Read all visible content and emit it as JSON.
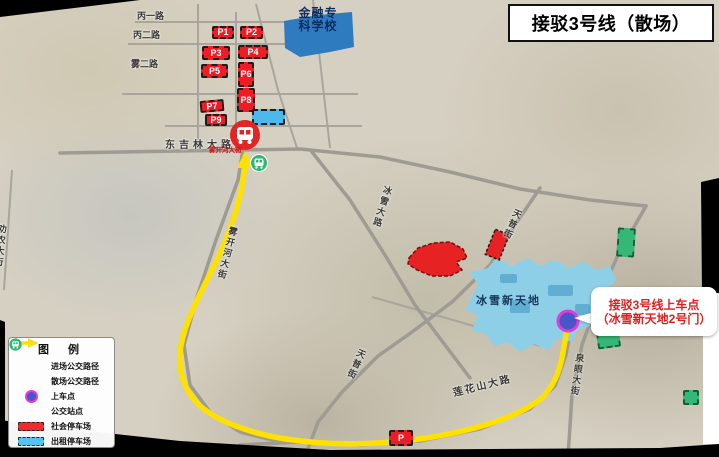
{
  "title": "接驳3号线（散场）",
  "legend": {
    "title": "图 例",
    "items": [
      {
        "label": "进场公交路径",
        "symbol": "purple-arrow",
        "color": "#7030a0"
      },
      {
        "label": "散场公交路径",
        "symbol": "yellow-arrow",
        "color": "#ffe100"
      },
      {
        "label": "上车点",
        "symbol": "boarding-dot",
        "color": "#4856c8"
      },
      {
        "label": "公交站点",
        "symbol": "bus-stop-icon",
        "color": "#2eb872"
      },
      {
        "label": "社会停车场",
        "symbol": "red-dashed-box",
        "color": "#ee2c2c"
      },
      {
        "label": "出租停车场",
        "symbol": "blue-dashed-box",
        "color": "#55c3ef"
      }
    ]
  },
  "map": {
    "school": {
      "line1": "金融专",
      "line2": "科学校"
    },
    "venue": "冰雪新天地",
    "callout": {
      "line1": "接驳3号线上车点",
      "line2": "（冰雪新天地2号门）"
    },
    "stop_name": "雾开河大街",
    "roads": {
      "bingyi": "丙一路",
      "binger": "丙二路",
      "wuer": "雾二路",
      "dongjilin": "东吉林大路",
      "wukaihe": "雾开河大街",
      "bingxue": "冰雪大路",
      "tianpu_north": "天普街",
      "tianpu_south": "天普街",
      "quanyan": "泉眼大街",
      "lianhuashan": "莲花山大路",
      "quannong": "劝农大街"
    },
    "parking": {
      "p1": "P1",
      "p2": "P2",
      "p3": "P3",
      "p4": "P4",
      "p5": "P5",
      "p6": "P6",
      "p7": "P7",
      "p8": "P8",
      "p9": "P9",
      "p_south": "P"
    }
  },
  "colors": {
    "route_yellow": "#ffe100",
    "enter_purple": "#7030a0",
    "parking_red": "#ee1c25",
    "taxi_blue": "#4db8ea",
    "green_lot": "#35b877",
    "boarding_fill": "#4856c8",
    "boarding_ring": "#e23bd9",
    "callout_red": "#e01f1f",
    "school_blue": "#2f7bbf",
    "venue_blue": "#8ecfe8"
  }
}
